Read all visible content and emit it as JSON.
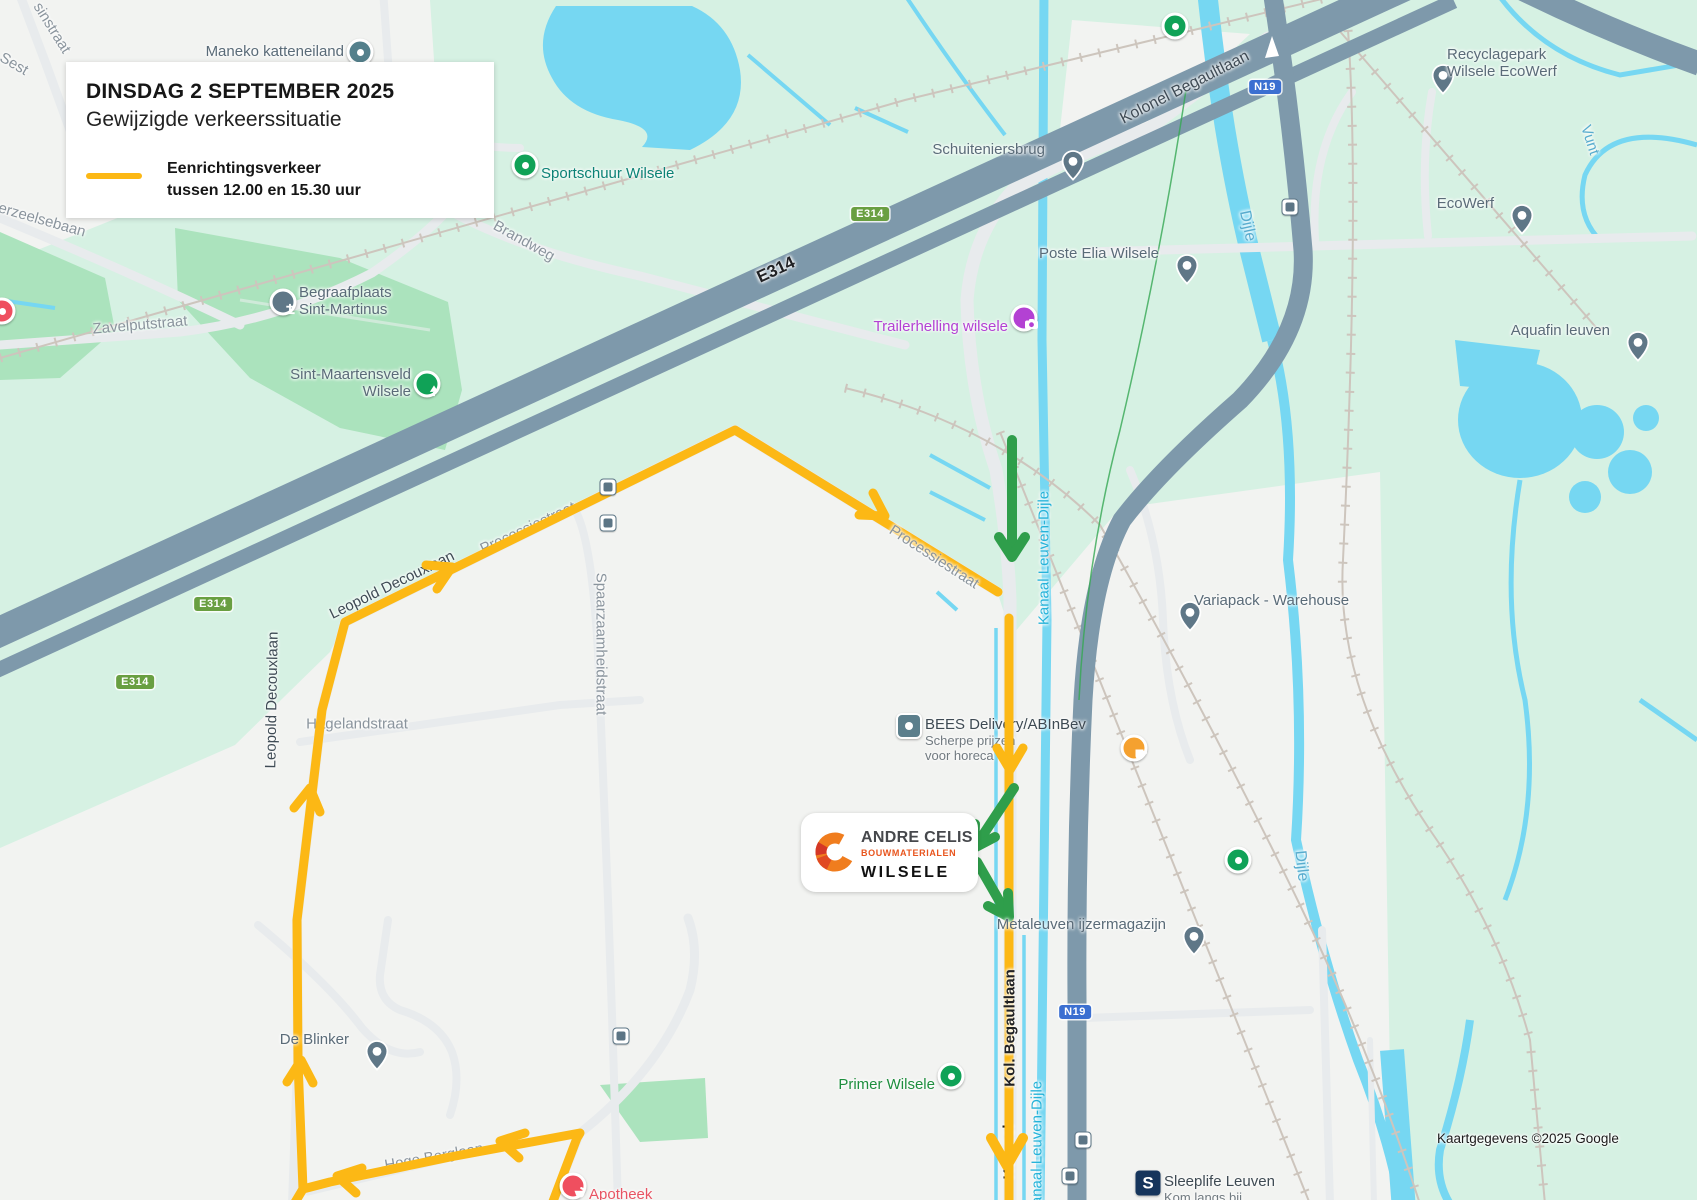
{
  "info_box": {
    "date": "DINSDAG 2 SEPTEMBER 2025",
    "subtitle": "Gewijzigde verkeerssituatie",
    "legend_line1": "Eenrichtingsverkeer",
    "legend_line2": "tussen 12.00 en 15.30 uur"
  },
  "brand": {
    "name": "ANDRE CELIS",
    "sub": "BOUWMATERIALEN",
    "location": "WILSELE"
  },
  "attribution": "Kaartgegevens ©2025 Google",
  "colors": {
    "mint": "#d6f1e3",
    "pale": "#f2f3f1",
    "park": "#abe3bd",
    "park_path": "#cfead9",
    "water": "#76d7f2",
    "slate": "#7e99ab",
    "road": "#e8ebed",
    "rail": "#cdc5bd",
    "bike": "#34a853",
    "route_yellow": "#fcb815",
    "arrow_green": "#2f9e4b",
    "label_road": "#8a949d",
    "label_dark": "#3f4b55",
    "label_black": "#202124",
    "label_water": "#58acce",
    "label_canal": "#26b3d9",
    "poi": "#5a6b78",
    "poi_title": "#3e4a53",
    "poi_sub": "#717a80",
    "poi_green": "#1e8e3e",
    "poi_teal": "#0c8276",
    "poi_purple": "#b341d3",
    "poi_red": "#e85463",
    "pin": "#5f7787",
    "marker_green": "#10a257",
    "marker_teal": "#54808c",
    "navy": "#16355c",
    "orange_cup": "#f5a12f",
    "bees": "#5c7f8c",
    "apo": "#ef4f5f",
    "shield_green": "#699f41",
    "shield_blue": "#3b6fd1"
  },
  "map": {
    "street_labels": [
      {
        "text": "sinstraat",
        "x": 52,
        "y": 28,
        "r": 58
      },
      {
        "text": "Sest",
        "x": 14,
        "y": 64,
        "r": 30
      },
      {
        "text": "erzeelsebaan",
        "x": 42,
        "y": 220,
        "r": 16
      },
      {
        "text": "Zavelputstraat",
        "x": 140,
        "y": 325,
        "r": -5
      },
      {
        "text": "Brandweg",
        "x": 524,
        "y": 241,
        "r": 29
      },
      {
        "text": "E314",
        "x": 776,
        "y": 270,
        "r": -25,
        "color": "label_black",
        "bold": true,
        "size": 17
      },
      {
        "text": "Kolonel Begaultlaan",
        "x": 1185,
        "y": 88,
        "r": -27,
        "color": "label_dark",
        "size": 16
      },
      {
        "text": "Processiestraat",
        "x": 528,
        "y": 528,
        "r": -25
      },
      {
        "text": "Processiestraat",
        "x": 934,
        "y": 557,
        "r": 33,
        "above": true
      },
      {
        "text": "Leopold Decouxlaan",
        "x": 392,
        "y": 585,
        "r": -26,
        "color": "label_dark"
      },
      {
        "text": "Leopold Decouxlaan",
        "x": 272,
        "y": 700,
        "r": -89,
        "color": "label_dark"
      },
      {
        "text": "Spaarzaamheidstraat",
        "x": 601,
        "y": 644,
        "r": 90
      },
      {
        "text": "Hagelandstraat",
        "x": 357,
        "y": 724,
        "r": 0
      },
      {
        "text": "Hoge Berglaan",
        "x": 434,
        "y": 1157,
        "r": -10
      },
      {
        "text": "Kol. Begaultlaan",
        "x": 1010,
        "y": 1028,
        "r": -90,
        "color": "label_black",
        "bold": true,
        "above": true
      },
      {
        "text": "Kolonel",
        "x": 1009,
        "y": 1152,
        "r": -90,
        "color": "label_black",
        "bold": true
      },
      {
        "text": "Dijle",
        "x": 1247,
        "y": 226,
        "r": 78,
        "color": "label_water",
        "size": 16
      },
      {
        "text": "Dijle",
        "x": 1301,
        "y": 866,
        "r": 84,
        "color": "label_water",
        "size": 16
      },
      {
        "text": "Vunt",
        "x": 1590,
        "y": 140,
        "r": 72,
        "color": "label_water",
        "size": 15
      },
      {
        "text": "Kanaal Leuven-Dijle",
        "x": 1044,
        "y": 558,
        "r": -90,
        "color": "label_canal"
      },
      {
        "text": "Kanaal Leuven-Dijle",
        "x": 1037,
        "y": 1148,
        "r": -90,
        "color": "label_canal"
      }
    ],
    "shields": [
      {
        "label": "E314",
        "kind": "e",
        "x": 870,
        "y": 214
      },
      {
        "label": "E314",
        "kind": "e",
        "x": 213,
        "y": 604
      },
      {
        "label": "E314",
        "kind": "e",
        "x": 135,
        "y": 682
      },
      {
        "label": "N19",
        "kind": "n",
        "x": 1265,
        "y": 87
      },
      {
        "label": "N19",
        "kind": "n",
        "x": 1075,
        "y": 1012
      }
    ],
    "pois": [
      {
        "id": "maneko-katteneiland",
        "icon": "circle",
        "mcolor": "marker_teal",
        "x": 360,
        "y": 52,
        "side": "left",
        "lines": [
          "Maneko katteneiland"
        ]
      },
      {
        "id": "schuiteniersbrug",
        "icon": "pin",
        "x": 1061,
        "y": 150,
        "side": "left",
        "lines": [
          "Schuiteniersbrug"
        ]
      },
      {
        "id": "poste-elia-wilsele",
        "icon": "pin",
        "x": 1175,
        "y": 254,
        "side": "left",
        "lines": [
          "Poste Elia Wilsele"
        ]
      },
      {
        "id": "trailerhelling-wilsele",
        "icon": "camera",
        "x": 1024,
        "y": 318,
        "side": "left",
        "color": "poi_purple",
        "lines": [
          "Trailerhelling wilsele"
        ]
      },
      {
        "id": "begraafplaats-sint-martinus",
        "icon": "cemetery",
        "x": 283,
        "y": 302,
        "side": "right",
        "lines": [
          "Begraafplaats",
          "Sint-Martinus"
        ]
      },
      {
        "id": "sint-maartensveld-wilsele",
        "icon": "tree",
        "x": 427,
        "y": 384,
        "side": "left",
        "lines": [
          "Sint-Maartensveld",
          "Wilsele"
        ]
      },
      {
        "id": "sportschuur-wilsele",
        "icon": "circle",
        "mcolor": "marker_green",
        "x": 525,
        "y": 165,
        "side": "right",
        "color": "poi_teal",
        "lines": [
          "Sportschuur Wilsele"
        ]
      },
      {
        "id": "recyclagepark-wilsele-ecowerf",
        "icon": "pin",
        "x": 1431,
        "y": 64,
        "side": "right",
        "lines": [
          "Recyclagepark",
          "Wilsele EcoWerf"
        ]
      },
      {
        "id": "ecowerf",
        "icon": "pin",
        "x": 1510,
        "y": 204,
        "side": "left",
        "lines": [
          "EcoWerf"
        ]
      },
      {
        "id": "aquafin-leuven",
        "icon": "pin",
        "x": 1626,
        "y": 331,
        "side": "left",
        "lines": [
          "Aquafin leuven"
        ]
      },
      {
        "id": "variapack-warehouse",
        "icon": "pin",
        "x": 1178,
        "y": 601,
        "side": "right",
        "lines": [
          "Variapack - Warehouse"
        ]
      },
      {
        "id": "bees-delivery",
        "icon": "square-bees",
        "x": 909,
        "y": 726,
        "side": "right",
        "layer": "low",
        "title": "BEES Delivery/ABInBev",
        "sub": [
          "Scherpe prijzen",
          "voor horeca"
        ]
      },
      {
        "id": "metaleuven-ijzermagazijn",
        "icon": "pin",
        "x": 1182,
        "y": 925,
        "side": "left",
        "lines": [
          "Metaleuven ijzermagazijn"
        ]
      },
      {
        "id": "de-blinker",
        "icon": "pin",
        "x": 365,
        "y": 1040,
        "side": "left",
        "lines": [
          "De Blinker"
        ]
      },
      {
        "id": "primer-wilsele",
        "icon": "circle",
        "mcolor": "marker_green",
        "x": 951,
        "y": 1076,
        "side": "left",
        "color": "poi_green",
        "lines": [
          "Primer Wilsele"
        ]
      },
      {
        "id": "apotheek-pharmanema",
        "icon": "pharma",
        "x": 573,
        "y": 1186,
        "side": "right",
        "color": "poi_red",
        "lines": [
          "Apotheek",
          "Pharmanema Leuven"
        ]
      },
      {
        "id": "sleeplife-leuven",
        "icon": "square-s",
        "x": 1148,
        "y": 1183,
        "side": "right",
        "title": "Sleeplife Leuven",
        "sub": [
          "Kom langs bij",
          "Sleeplife O"
        ]
      },
      {
        "id": "green-marker-highway",
        "icon": "circle",
        "mcolor": "marker_green",
        "x": 1175,
        "y": 26
      },
      {
        "id": "green-marker-east",
        "icon": "circle",
        "mcolor": "marker_green",
        "x": 1238,
        "y": 860
      },
      {
        "id": "cafe-marker",
        "icon": "cup",
        "x": 1134,
        "y": 748
      },
      {
        "id": "red-marker-edge",
        "icon": "circle",
        "mcolor": "apo",
        "x": 2,
        "y": 311
      }
    ],
    "bus_stops": [
      {
        "x": 1290,
        "y": 207
      },
      {
        "x": 608,
        "y": 487
      },
      {
        "x": 608,
        "y": 523
      },
      {
        "x": 621,
        "y": 1036
      },
      {
        "x": 1083,
        "y": 1140
      },
      {
        "x": 1070,
        "y": 1176
      }
    ]
  }
}
